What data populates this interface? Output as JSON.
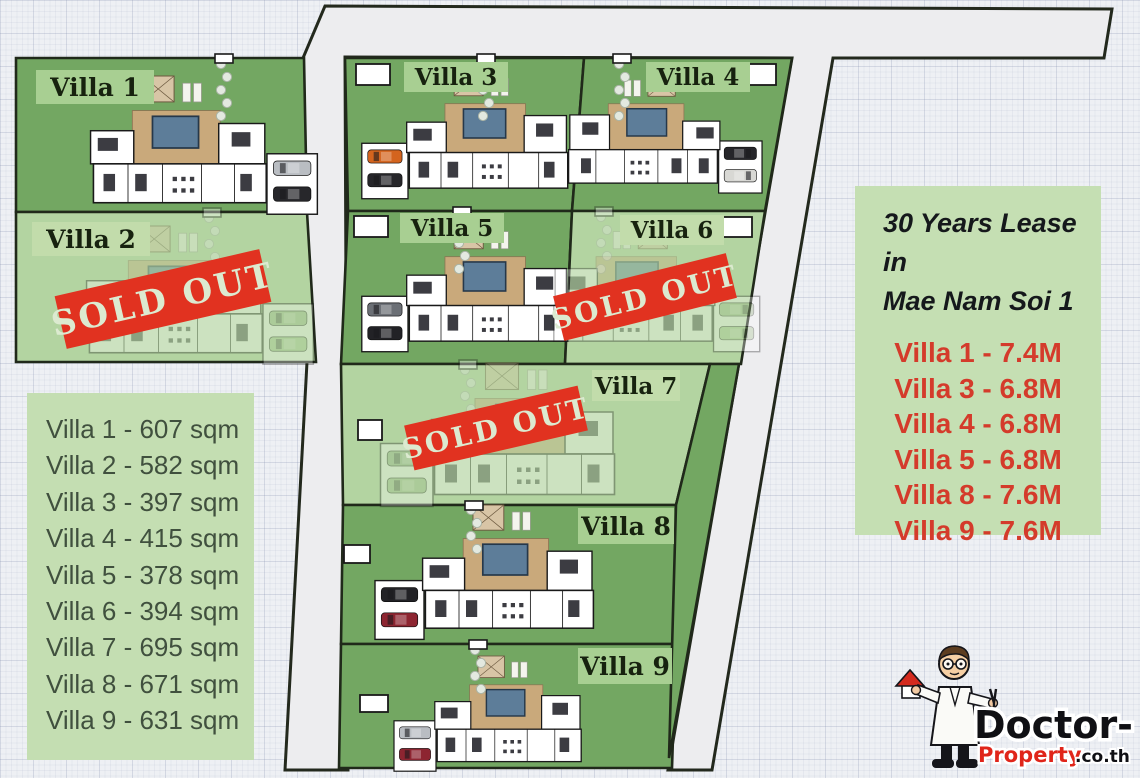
{
  "map": {
    "villas": [
      {
        "name": "Villa 1",
        "status": "available"
      },
      {
        "name": "Villa 2",
        "status": "sold_out"
      },
      {
        "name": "Villa 3",
        "status": "available"
      },
      {
        "name": "Villa 4",
        "status": "available"
      },
      {
        "name": "Villa 5",
        "status": "available"
      },
      {
        "name": "Villa 6",
        "status": "sold_out"
      },
      {
        "name": "Villa 7",
        "status": "sold_out"
      },
      {
        "name": "Villa 8",
        "status": "available"
      },
      {
        "name": "Villa 9",
        "status": "available"
      }
    ],
    "sold_out_label": "SOLD OUT"
  },
  "legend_sizes": {
    "items": [
      "Villa 1 - 607 sqm",
      "Villa 2 - 582 sqm",
      "Villa 3 - 397 sqm",
      "Villa 4 - 415 sqm",
      "Villa 5 - 378 sqm",
      "Villa 6 - 394 sqm",
      "Villa 7 - 695 sqm",
      "Villa 8 - 671 sqm",
      "Villa 9 - 631 sqm"
    ]
  },
  "price_panel": {
    "title_line1": "30 Years Lease in",
    "title_line2": "Mae Nam Soi 1",
    "items": [
      "Villa 1 - 7.4M",
      "Villa 3 - 6.8M",
      "Villa 4 - 6.8M",
      "Villa 5 - 6.8M",
      "Villa 8 - 7.6M",
      "Villa 9 - 7.6M"
    ]
  },
  "logo": {
    "brand_black": "Doctor-",
    "brand_red": "Property",
    "brand_suffix": ".co.th"
  },
  "colors": {
    "plot_available": "#73a762",
    "plot_sold": "#b3d4a1",
    "label_box": "#a8cf92",
    "outline": "#20291a",
    "road": "#ededef",
    "stamp_red": "#e13220",
    "price_red": "#d43b2b",
    "legend_bg": "#c4deb2",
    "pool_blue": "#5d7d99",
    "deck_tan": "#c9a97b"
  }
}
